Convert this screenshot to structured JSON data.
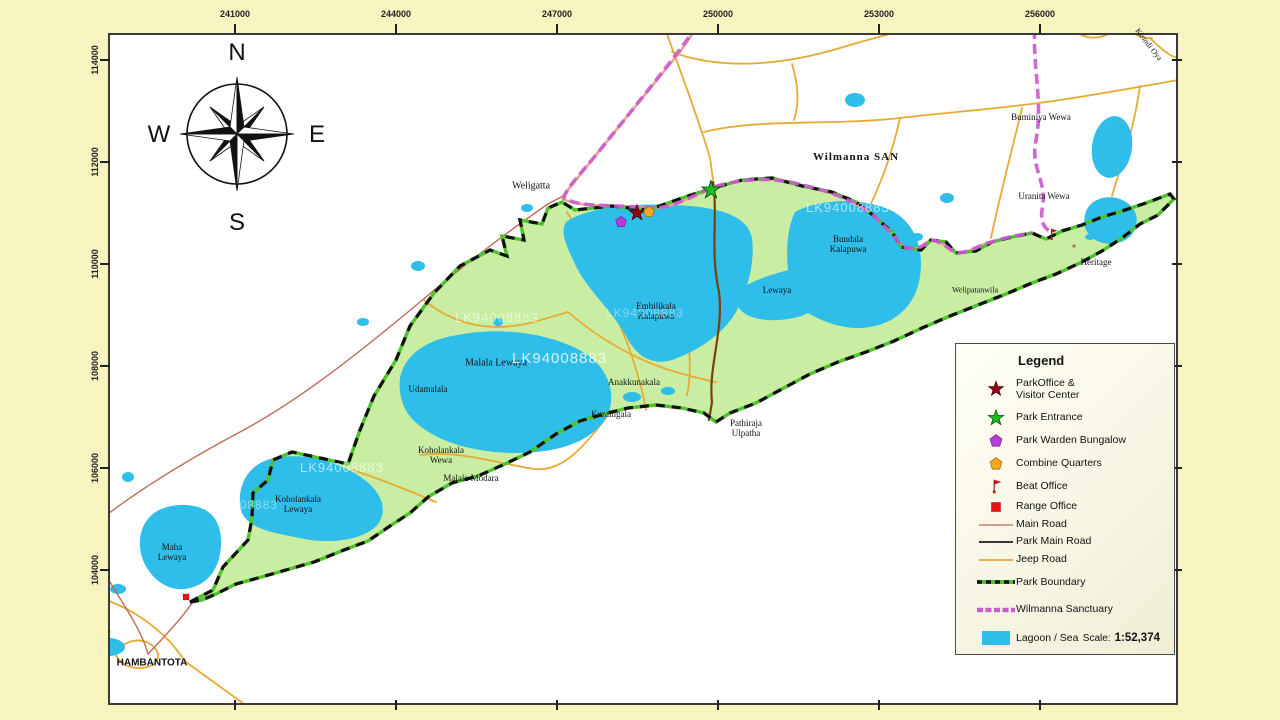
{
  "axes": {
    "top": [
      {
        "label": "241000",
        "x": 235
      },
      {
        "label": "244000",
        "x": 396
      },
      {
        "label": "247000",
        "x": 557
      },
      {
        "label": "250000",
        "x": 718
      },
      {
        "label": "253000",
        "x": 879
      },
      {
        "label": "256000",
        "x": 1040
      }
    ],
    "left": [
      {
        "label": "114000",
        "y": 60
      },
      {
        "label": "112000",
        "y": 162
      },
      {
        "label": "110000",
        "y": 264
      },
      {
        "label": "108000",
        "y": 366
      },
      {
        "label": "106000",
        "y": 468
      },
      {
        "label": "104000",
        "y": 570
      }
    ]
  },
  "compass": {
    "north": "N",
    "east": "E",
    "south": "S",
    "west": "W"
  },
  "watermark": {
    "text": "LK94008883",
    "positions": [
      {
        "x": 455,
        "y": 310,
        "size": 13,
        "opacity": 0.55
      },
      {
        "x": 512,
        "y": 350,
        "size": 15,
        "opacity": 0.8
      },
      {
        "x": 806,
        "y": 200,
        "size": 13,
        "opacity": 0.6
      },
      {
        "x": 300,
        "y": 460,
        "size": 13,
        "opacity": 0.6
      },
      {
        "x": 200,
        "y": 498,
        "size": 12,
        "opacity": 0.45
      },
      {
        "x": 606,
        "y": 306,
        "size": 12,
        "opacity": 0.4
      }
    ]
  },
  "map": {
    "labels": [
      {
        "text": "Weligatta",
        "x": 531,
        "y": 186,
        "size": 10
      },
      {
        "text": "Wilmanna  SAN",
        "x": 856,
        "y": 157,
        "size": 11,
        "bold": true,
        "ls": 1
      },
      {
        "text": "Buminiya Wewa",
        "x": 1041,
        "y": 117,
        "size": 9
      },
      {
        "text": "Uranita Wewa",
        "x": 1044,
        "y": 196,
        "size": 9
      },
      {
        "text": "Bundala\nKalapuwa",
        "x": 848,
        "y": 244,
        "size": 9
      },
      {
        "text": "Lewaya",
        "x": 777,
        "y": 290,
        "size": 9
      },
      {
        "text": "Embilikala\nKalapuwa",
        "x": 656,
        "y": 311,
        "size": 9
      },
      {
        "text": "Heritage",
        "x": 1096,
        "y": 262,
        "size": 9
      },
      {
        "text": "Welipatanwila",
        "x": 975,
        "y": 291,
        "size": 8
      },
      {
        "text": "Malala Lewaya",
        "x": 496,
        "y": 363,
        "size": 10
      },
      {
        "text": "Udamalala",
        "x": 428,
        "y": 389,
        "size": 9
      },
      {
        "text": "Anakkunakala",
        "x": 634,
        "y": 382,
        "size": 9
      },
      {
        "text": "Kuralugala",
        "x": 611,
        "y": 414,
        "size": 9
      },
      {
        "text": "Pathiraja\nUlpatha",
        "x": 746,
        "y": 428,
        "size": 9
      },
      {
        "text": "Koholankala\nWewa",
        "x": 441,
        "y": 455,
        "size": 9
      },
      {
        "text": "Malala Modara",
        "x": 471,
        "y": 478,
        "size": 9
      },
      {
        "text": "Koholankala\nLewaya",
        "x": 298,
        "y": 504,
        "size": 9
      },
      {
        "text": "Maha\nLewaya",
        "x": 172,
        "y": 552,
        "size": 9
      },
      {
        "text": "HAMBANTOTA",
        "x": 152,
        "y": 663,
        "size": 10,
        "bold": true,
        "sans": true
      },
      {
        "text": "Kirindi Oya",
        "x": 1148,
        "y": 45,
        "size": 8,
        "rotate": 52
      }
    ],
    "markers": [
      {
        "type": "park-office",
        "x": 637,
        "y": 213
      },
      {
        "type": "park-entrance",
        "x": 711,
        "y": 190
      },
      {
        "type": "warden-bungalow",
        "x": 621,
        "y": 222
      },
      {
        "type": "combine-quarters",
        "x": 649,
        "y": 212
      },
      {
        "type": "beat-office",
        "x": 1053,
        "y": 234
      },
      {
        "type": "range-office",
        "x": 186,
        "y": 597
      },
      {
        "type": "site-dot",
        "x": 1074,
        "y": 246
      }
    ]
  },
  "legend": {
    "title": "Legend",
    "items": [
      {
        "symbol": "park-office",
        "label": "ParkOffice &\nVisitor Center",
        "h": 34
      },
      {
        "symbol": "park-entrance",
        "label": "Park Entrance",
        "h": 23
      },
      {
        "symbol": "warden-bungalow",
        "label": "Park Warden Bungalow",
        "h": 23
      },
      {
        "symbol": "combine-quarters",
        "label": "Combine Quarters",
        "h": 23
      },
      {
        "symbol": "beat-office",
        "label": "Beat Office",
        "h": 22
      },
      {
        "symbol": "range-office",
        "label": "Range Office",
        "h": 19
      },
      {
        "symbol": "main-road",
        "label": "Main Road",
        "h": 17
      },
      {
        "symbol": "park-main-road",
        "label": "Park Main Road",
        "h": 17
      },
      {
        "symbol": "jeep-road",
        "label": "Jeep Road",
        "h": 19
      },
      {
        "symbol": "park-boundary",
        "label": "Park Boundary",
        "h": 26
      },
      {
        "symbol": "wilmanna-sanctuary",
        "label": "Wilmanna Sanctuary",
        "h": 29
      },
      {
        "symbol": "lagoon-sea",
        "label": "Lagoon / Sea",
        "h": 28
      }
    ],
    "scale_label": "Scale:",
    "scale_value": "1:52,374"
  },
  "colors": {
    "background": "#f7f4bf",
    "park_green": "#c9eda2",
    "water": "#2fbde9",
    "boundary_green": "#4ec42a",
    "boundary_black": "#111111",
    "sanctuary_magenta": "#cb5ccf",
    "jeep_road": "#e6ab33",
    "main_road": "#bf6a5a",
    "coast_road": "#eda294",
    "park_main_road": "#7d3f10",
    "office_star": "#990011",
    "entrance_star": "#22bb22",
    "warden_pentagon": "#b43fd9",
    "quarters_pentagon": "#f5a71f",
    "beat_flag": "#cc1111",
    "range_square": "#ee1111"
  }
}
